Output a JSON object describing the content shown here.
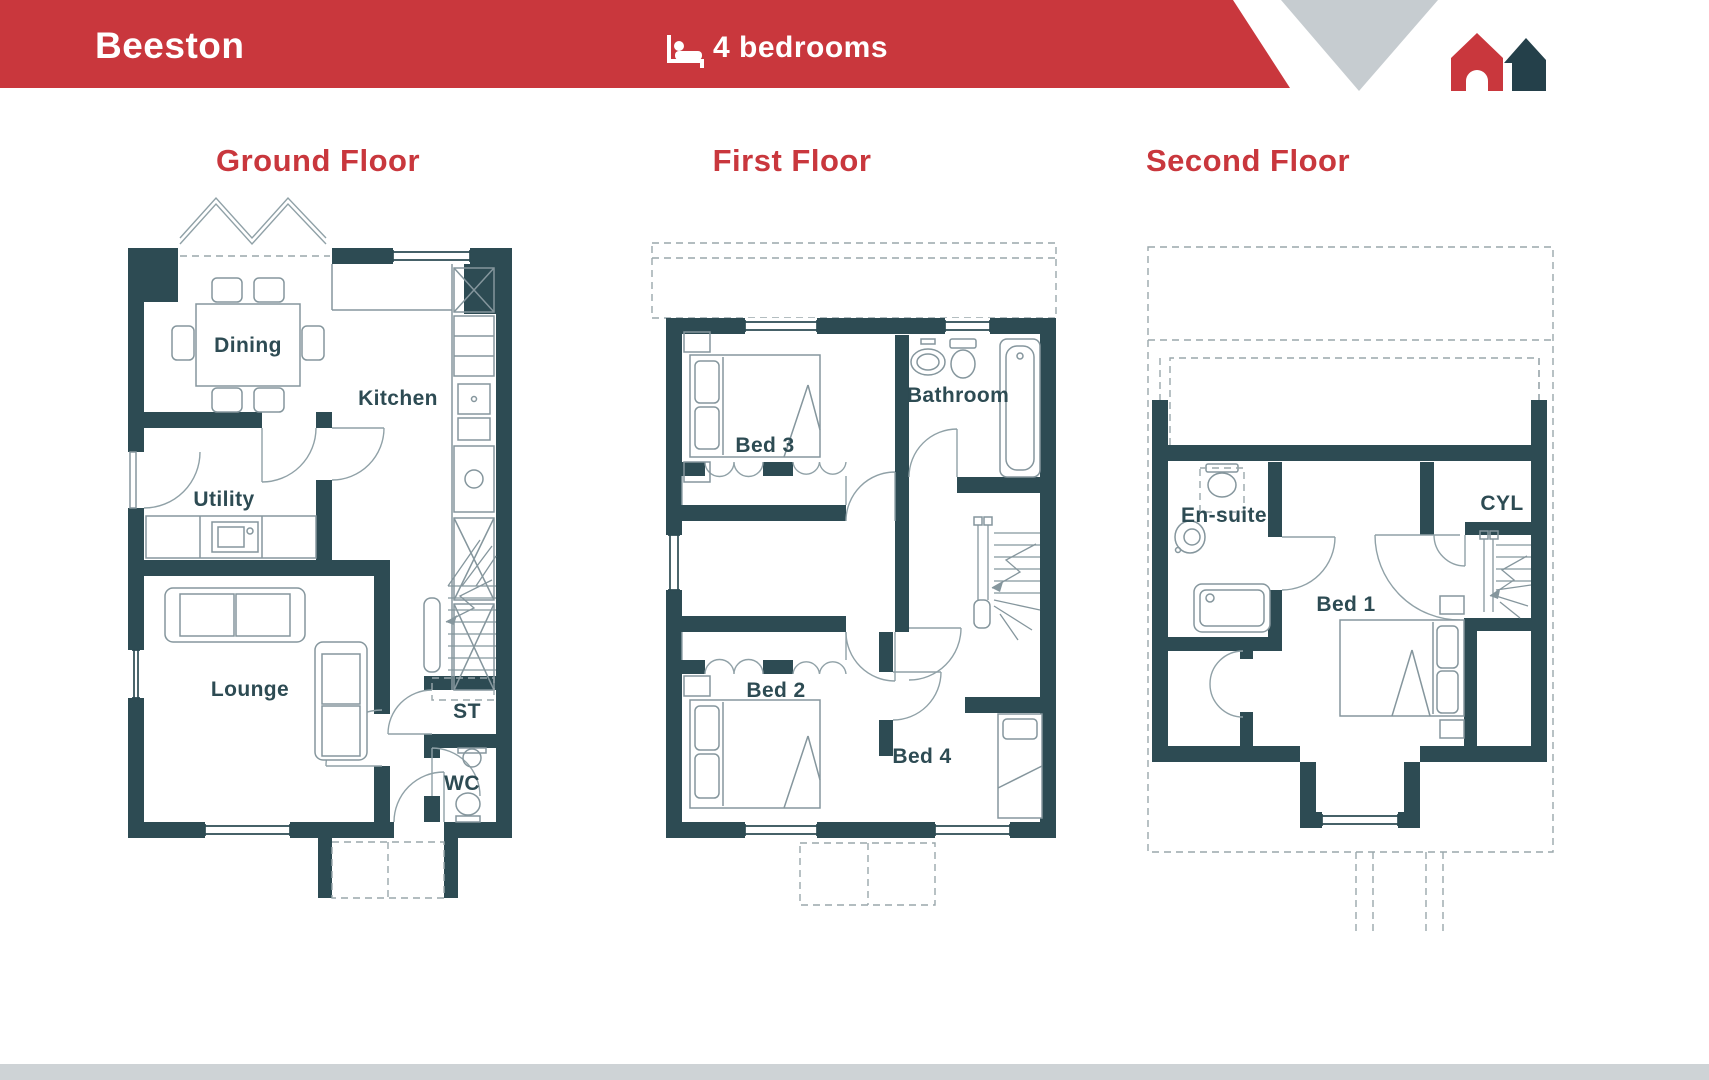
{
  "header": {
    "project_name": "Beeston",
    "bedrooms": "4 bedrooms"
  },
  "floors": [
    {
      "label": "Ground Floor",
      "rooms": {
        "dining": "Dining",
        "kitchen": "Kitchen",
        "utility": "Utility",
        "lounge": "Lounge",
        "st": "ST",
        "wc": "WC"
      }
    },
    {
      "label": "First Floor",
      "rooms": {
        "bed3": "Bed 3",
        "bathroom": "Bathroom",
        "bed2": "Bed 2",
        "bed4": "Bed 4"
      }
    },
    {
      "label": "Second Floor",
      "rooms": {
        "ensuite": "En-suite",
        "cyl": "CYL",
        "bed1": "Bed 1"
      }
    }
  ],
  "colors": {
    "accent_red": "#c9373d",
    "wall_teal": "#2d4b53",
    "roof_gray": "#c6ccd0",
    "footer_gray": "#ced3d6"
  }
}
